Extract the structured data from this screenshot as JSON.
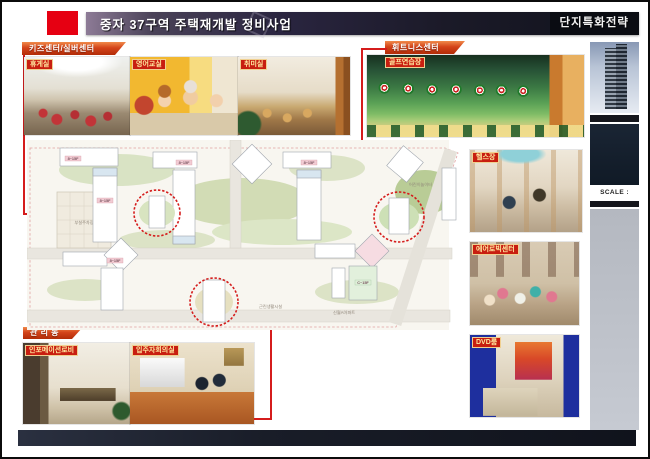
{
  "header": {
    "title": "중자 37구역 주택재개발 정비사업",
    "right_label": "단지특화전략",
    "accent_color": "#e60012"
  },
  "kids_center": {
    "ribbon": "키즈센터/실버센터",
    "photo_labels": {
      "lounge": "휴게실",
      "english_class": "영어교실",
      "hobby_room": "취미실"
    }
  },
  "fitness_center": {
    "ribbon": "휘트니스센터",
    "photo_labels": {
      "golf": "골프연습장",
      "gym": "헬스장",
      "aerobics": "에어로빅센터",
      "dvd": "DVD룸"
    }
  },
  "management": {
    "ribbon": "관 리 동",
    "photo_labels": {
      "info_lobby": "인포메이션로비",
      "meeting_room": "입주자회의실"
    }
  },
  "site_plan": {
    "building_label": "8~15F",
    "building_label_alt": "C~15F",
    "area_labels": {
      "retail": "근린생활시설",
      "apartment": "신월A아파트",
      "parking": "부설주차장",
      "playground": "어린이놀이터"
    },
    "highlight_color": "#d51c1c"
  },
  "sidebar": {
    "scale_label": "SCALE : NONE"
  }
}
